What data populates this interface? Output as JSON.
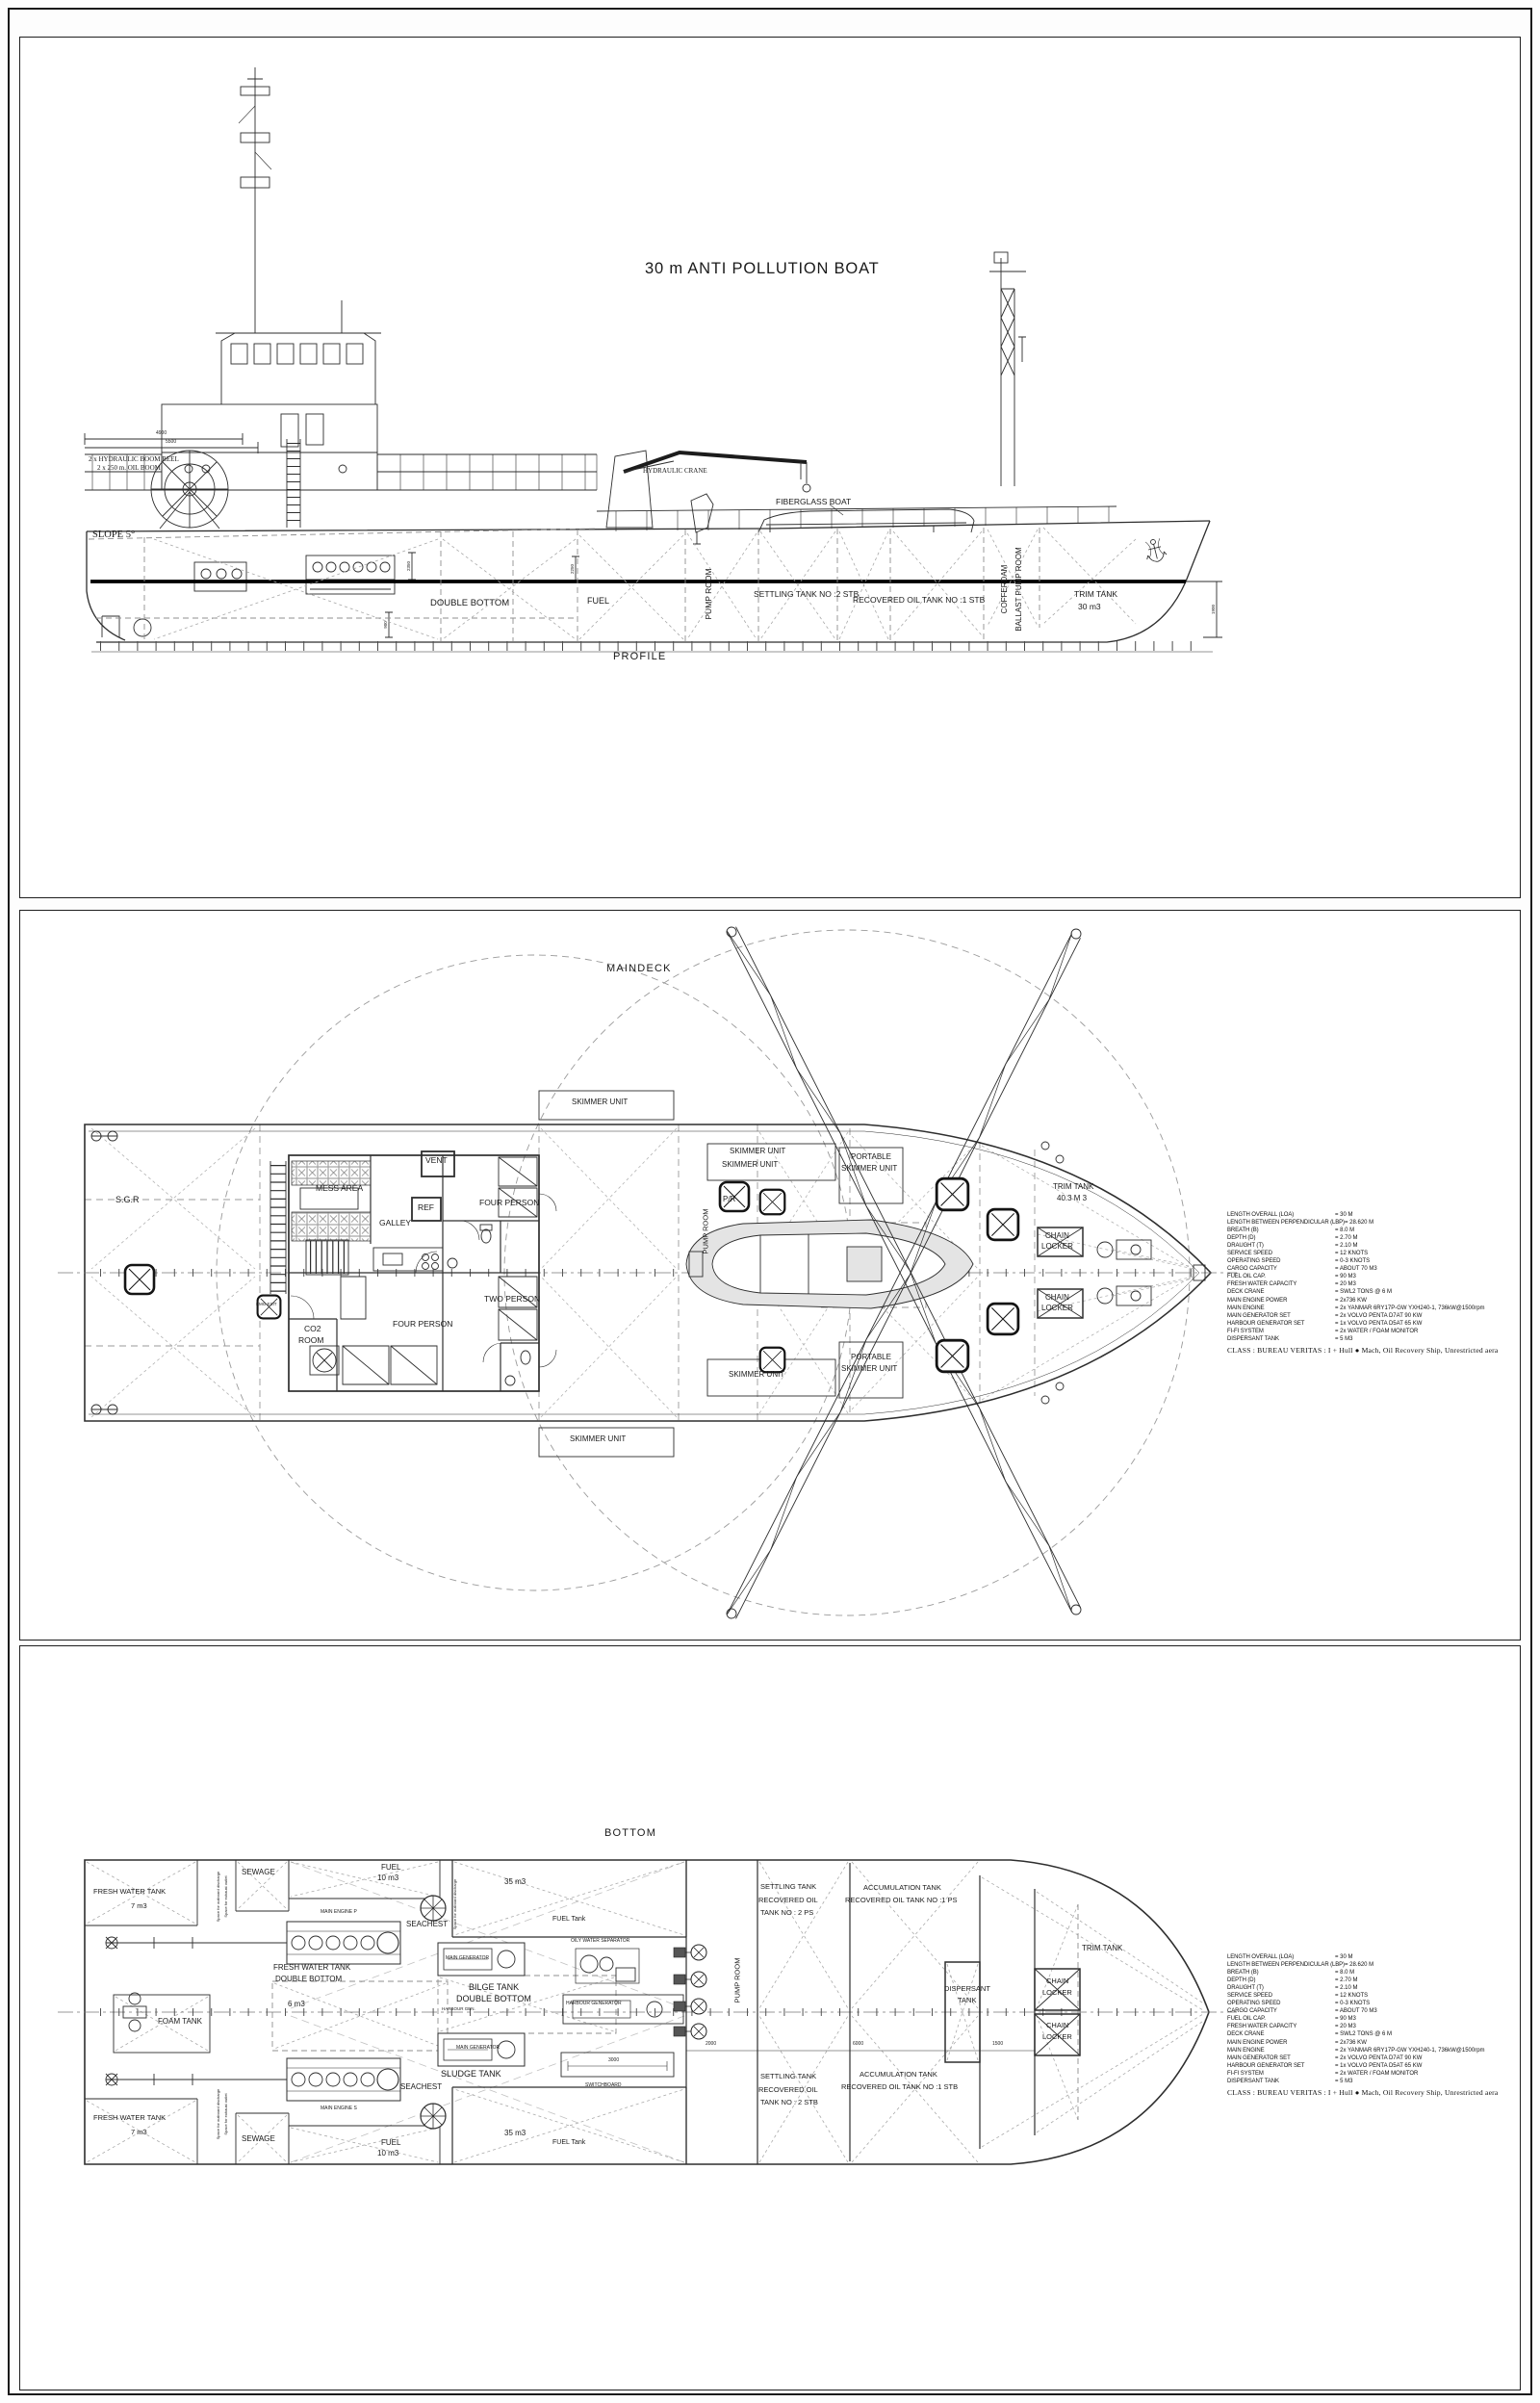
{
  "title": "30 m ANTI POLLUTION BOAT",
  "profile": {
    "view_label": "PROFILE",
    "boom_reel_line1": "2 x HYDRAULIC BOOM REEL",
    "boom_reel_line2": "2 x 250 m. OIL BOOM",
    "slope": "SLOPE 5°",
    "hydraulic_crane": "HYDRAULIC CRANE",
    "fiberglass_boat": "FIBERGLASS BOAT",
    "double_bottom": "DOUBLE BOTTOM",
    "fuel": "FUEL",
    "pump_room": "PUMP ROOM",
    "settling_tank": "SETTLING TANK NO :2 STB",
    "recovered_oil_tank": "RECOVERED OIL TANK NO :1 STB",
    "cofferdam": "COFFERDAM",
    "ballast_pump_room": "BALLAST PUMP ROOM",
    "trim_tank": "TRIM TANK",
    "trim_tank_volume": "30 m3",
    "dim_4900": "4900",
    "dim_5500": "5500",
    "dim_2350": "2350",
    "dim_2250": "2250",
    "dim_900": "900",
    "dim_1900": "1900"
  },
  "maindeck": {
    "view_label": "MAINDECK",
    "skimmer_unit": "SKIMMER UNIT",
    "portable": "PORTABLE",
    "sgr": "S.G.R",
    "mess_area": "MESS AREA",
    "vent": "VENT",
    "ref": "REF",
    "galley": "GALLEY",
    "four_person": "FOUR PERSON",
    "two_person": "TWO PERSON",
    "co2": "CO2",
    "room": "ROOM",
    "emg_exit": "EMG EXIT",
    "pr": "P/R",
    "pump_room": "PUMP ROOM",
    "trim_tank": "TRIM TANK",
    "trim_tank_volume": "40.3 M 3",
    "chain": "CHAIN",
    "locker": "LOCKER"
  },
  "bottom": {
    "view_label": "BOTTOM",
    "fresh_water_tank": "FRESH WATER TANK",
    "fresh_water_volume": "7 m3",
    "sewage": "SEWAGE",
    "fuel": "FUEL",
    "fuel_volume": "10 m3",
    "volume_35": "35 m3",
    "fuel_tank": "FUEL Tank",
    "seachest": "SEACHEST",
    "space_outboard": "Space for outboard discharge",
    "space_exhaust": "Space for exhaust outlet",
    "main_engine_p": "MAIN ENGINE P",
    "main_engine_s": "MAIN ENGINE S",
    "double_bottom": "DOUBLE BOTTOM",
    "volume_6": "6 m3",
    "foam_tank": "FOAM TANK",
    "main_generator": "MAIN GENERATOR",
    "bilge_tank": "BILGE TANK",
    "harbour_gen": "HARBOUR GEN.",
    "sludge_tank": "SLUDGE TANK",
    "oily_water_separator": "OILY WATER SEPARATOR",
    "harbour_generator": "HARBOUR GENERATOR",
    "switchboard": "SWITCHBOARD",
    "pump_room": "PUMP ROOM",
    "settling_tank": "SETTLING TANK",
    "recovered_oil": "RECOVERED OIL",
    "tank_no_2_ps": "TANK NO : 2  PS",
    "tank_no_2_stb": "TANK NO : 2  STB",
    "accumulation_tank": "ACCUMULATION TANK",
    "recovered_no1_ps": "RECOVERED OIL TANK NO :1 PS",
    "recovered_no1_stb": "RECOVERED OIL TANK NO :1 STB",
    "dispersant": "DISPERSANT",
    "tank": "TANK",
    "trim_tank": "TRIM TANK",
    "chain": "CHAIN",
    "locker": "LOCKER",
    "dim_6000": "6000",
    "dim_1500": "1500",
    "dim_2000": "2000",
    "dim_3000": "3000"
  },
  "specs": {
    "items": [
      {
        "label": "LENGTH OVERALL   (LOA)",
        "value": "=  30 M"
      },
      {
        "label": "LENGTH BETWEEN PERPENDICULAR   (LBP)",
        "value": "=  28.620  M"
      },
      {
        "label": "BREATH  (B)",
        "value": "=  8.0   M"
      },
      {
        "label": "DEPTH  (D)",
        "value": "=  2.70  M"
      },
      {
        "label": "DRAUGHT  (T)",
        "value": "=  2.10   M"
      },
      {
        "label": "SERVICE SPEED",
        "value": "=  12 KNOTS"
      },
      {
        "label": "OPERATING SPEED",
        "value": "=  0-3 KNOTS"
      },
      {
        "label": "CARGO CAPACITY",
        "value": "=  ABOUT 70 M3"
      },
      {
        "label": "FUEL OIL CAP.",
        "value": "=  90 M3"
      },
      {
        "label": "FRESH WATER  CAPACITY",
        "value": "=  20  M3"
      },
      {
        "label": "DECK CRANE",
        "value": "=  SWL2 TONS @ 6 M"
      },
      {
        "label": "MAIN ENGINE POWER",
        "value": "=  2x736 KW"
      },
      {
        "label": "MAIN ENGINE",
        "value": "=  2x YANMAR 6RY17P-GW YXH240-1, 736kW@1500rpm"
      },
      {
        "label": "MAIN GENERATOR SET",
        "value": "=  2x VOLVO PENTA D7AT 90 KW"
      },
      {
        "label": "HARBOUR GENERATOR SET",
        "value": "=  1x VOLVO PENTA D5AT 65 KW"
      },
      {
        "label": "FI-FI SYSTEM",
        "value": "=  2x WATER / FOAM MONITOR"
      },
      {
        "label": "DISPERSANT TANK",
        "value": "=  5 M3"
      }
    ],
    "class_note": "CLASS : BUREAU VERITAS : I + Hull ● Mach, Oil Recovery Ship, Unrestricted aera"
  }
}
